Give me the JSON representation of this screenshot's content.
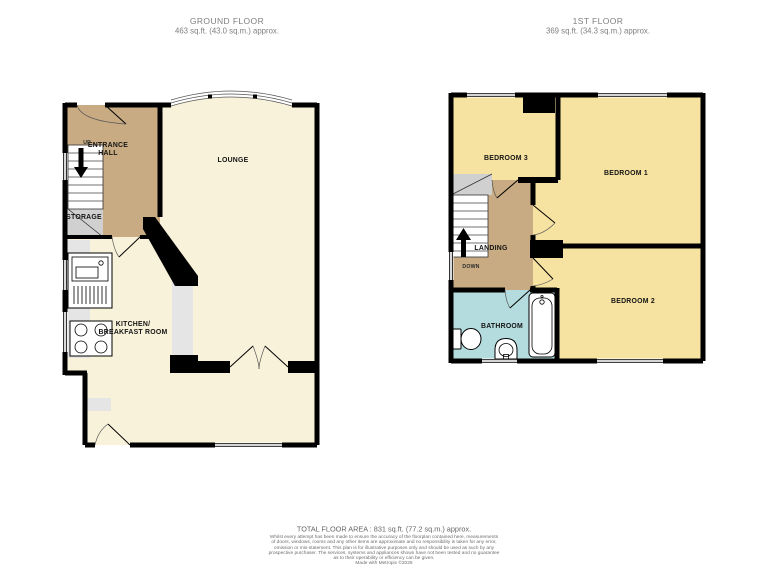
{
  "ground_floor": {
    "title": "GROUND FLOOR",
    "area": "463 sq.ft. (43.0 sq.m.) approx.",
    "labels": {
      "lounge": "LOUNGE",
      "entrance_hall_line1": "ENTRANCE",
      "entrance_hall_line2": "HALL",
      "up": "UP",
      "storage": "STORAGE",
      "kitchen_line1": "KITCHEN/",
      "kitchen_line2": "BREAKFAST ROOM"
    }
  },
  "first_floor": {
    "title": "1ST FLOOR",
    "area": "369 sq.ft. (34.3 sq.m.) approx.",
    "labels": {
      "bedroom1": "BEDROOM 1",
      "bedroom2": "BEDROOM 2",
      "bedroom3": "BEDROOM 3",
      "landing": "LANDING",
      "down": "DOWN",
      "bathroom": "BATHROOM"
    }
  },
  "footer": {
    "total_area": "TOTAL FLOOR AREA : 831 sq.ft. (77.2 sq.m.) approx.",
    "disclaimer_lines": [
      "Whilst every attempt has been made to ensure the accuracy of the floorplan contained here, measurements",
      "of doors, windows, rooms and any other items are approximate and no responsibility is taken for any error,",
      "omission or mis-statement. This plan is for illustrative purposes only and should be used as such by any",
      "prospective purchaser. The services, systems and appliances shown have not been tested and no guarantee",
      "as to their operability or efficiency can be given."
    ],
    "credit": "Made with Metropix ©2025"
  },
  "colors": {
    "wall": "#000000",
    "room_cream": "#f9f2da",
    "room_yellow": "#f6e3a1",
    "hall_tan": "#c8ab82",
    "bathroom_blue": "#b4dcdf",
    "storage_gray": "#d0d0d0",
    "counter_gray": "#e5e5e5"
  }
}
